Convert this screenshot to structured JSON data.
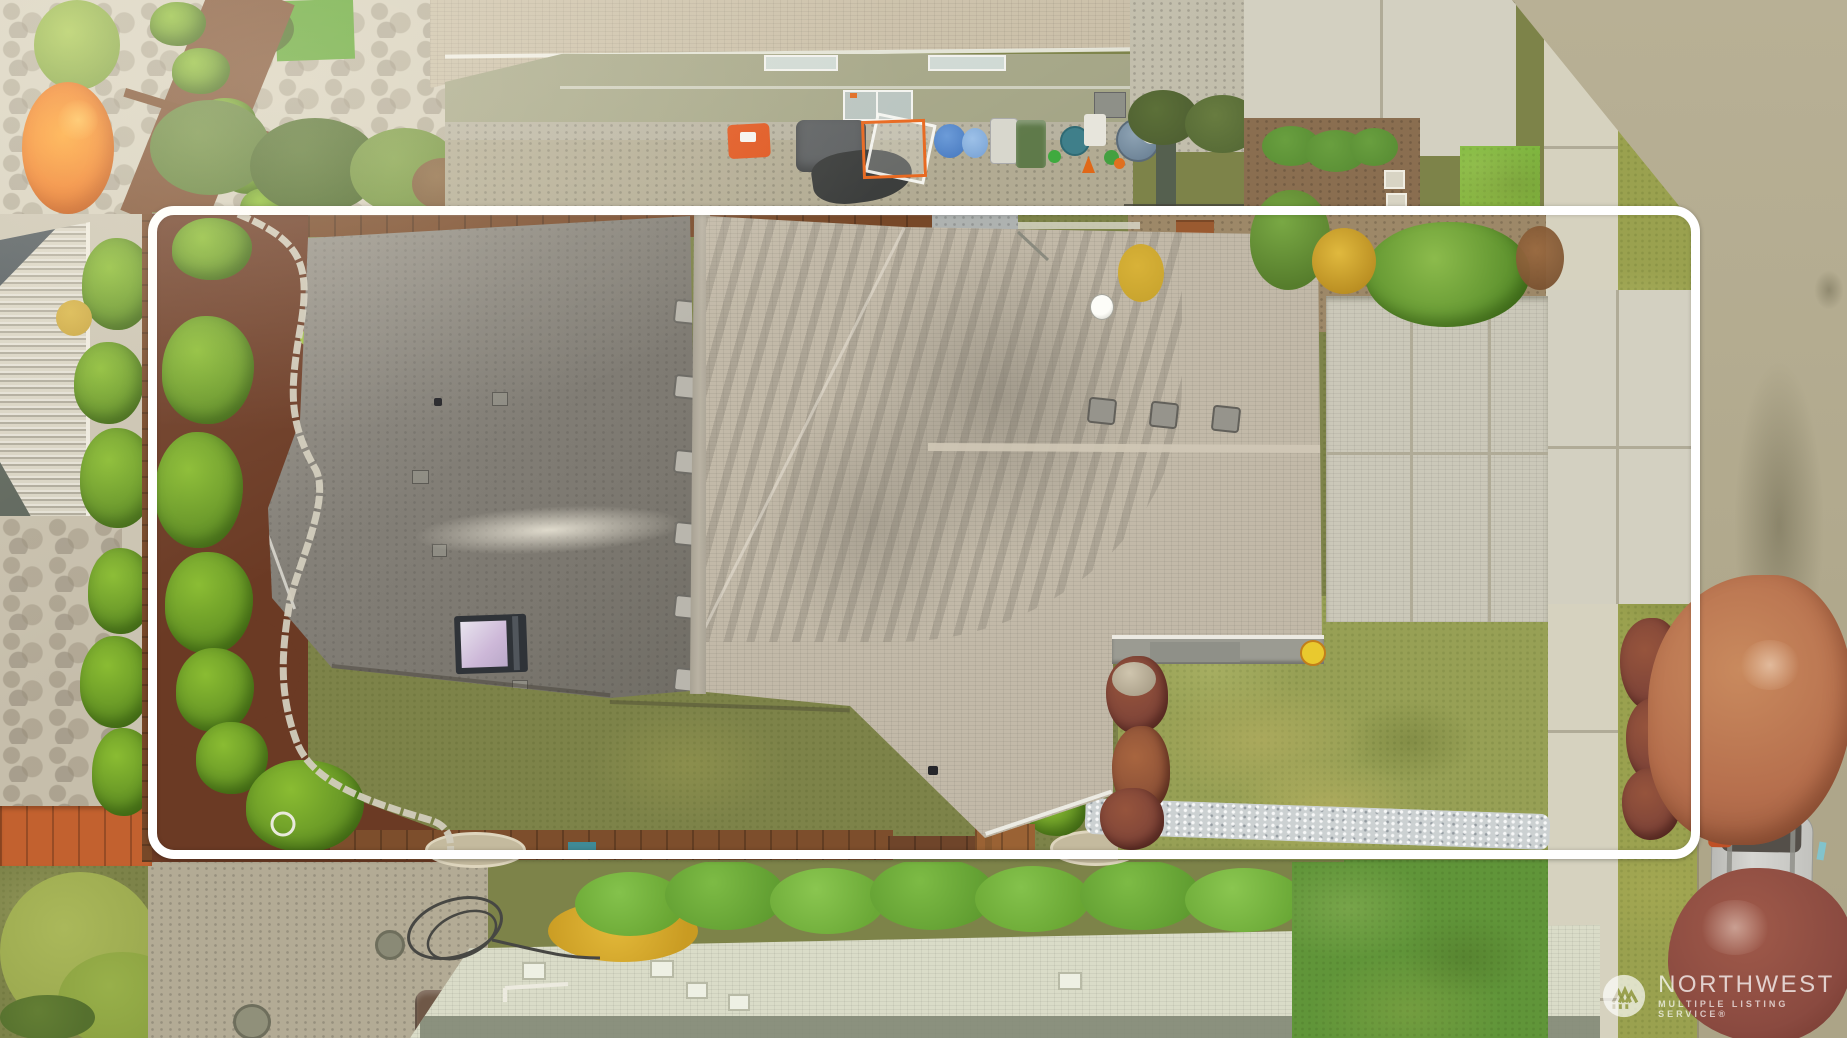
{
  "meta": {
    "type": "aerial-drone-photo",
    "description": "Overhead aerial view of a single-family home and lot with a white property boundary outline drawn over the photo",
    "width_px": 1847,
    "height_px": 1038
  },
  "watermark": {
    "brand": "NORTHWEST",
    "tagline": "MULTIPLE LISTING SERVICE®",
    "logo": "nwmls-mountains-logo"
  },
  "overlay": {
    "property_boundary": {
      "shape": "rounded-rectangle",
      "color": "#ffffff",
      "stroke_px": 9
    }
  },
  "palette": {
    "street": "#b4ac91",
    "curb": "#8d8769",
    "sidewalk": "#d6d2bf",
    "sidewalkJoint": "#b0ab97",
    "driveway": "#cbc8b9",
    "apron": "#d3d0c1",
    "concreteTop": "#d5cfbd",
    "lawnBack": "#7d8349",
    "lawnFront": "#97a055",
    "lawnRich": "#609539",
    "grassStrip": "#9aa14f",
    "turf": "#5ca42e",
    "cypress": "#8abc32",
    "cypressDark": "#5e8d22",
    "hedge": "#74b13c",
    "yellowBush": "#d9ab2c",
    "mulch": "#6b3a24",
    "bedGravel": "#9d8868",
    "stoneEdge": "#d2ccbd",
    "fenceBrown": "#774828",
    "deckWood": "#7d4e2c",
    "terracotta": "#c2612f",
    "roofDark": "#86827a",
    "roofMid": "#9b958a",
    "roofLight": "#c2b9a8",
    "ridgeCap": "#b9b2a3",
    "wallGray": "#9b9b92",
    "neighborRoof": "#cabfa8",
    "neighborWall": "#a5a687",
    "neighborYard": "#b2ab93",
    "bottomRoof": "#dadcc8",
    "bottomEave": "#828876",
    "orangeTree": "#f17a1d",
    "rustTree": "#b66f4d",
    "maroonTree": "#8a4a40",
    "maroonBush": "#7d4338",
    "gravelYard": "#b3ab95",
    "pebblePath": "#ccd1d2",
    "carBody": "#c7c7c3",
    "boundary": "#ffffff"
  },
  "scene": {
    "subject_lot": [
      "main-house-roof",
      "backyard-lawn",
      "front-lawn",
      "driveway",
      "cypress-row",
      "mulch-planting-beds",
      "wood-deck",
      "gravel-path",
      "skylight",
      "roof-vents"
    ],
    "surroundings": [
      "top-neighbor-house",
      "bottom-neighbor-house",
      "left-neighbor-patio-pergola",
      "street",
      "sidewalk",
      "parking-strip",
      "parked-car",
      "autumn-trees"
    ]
  }
}
